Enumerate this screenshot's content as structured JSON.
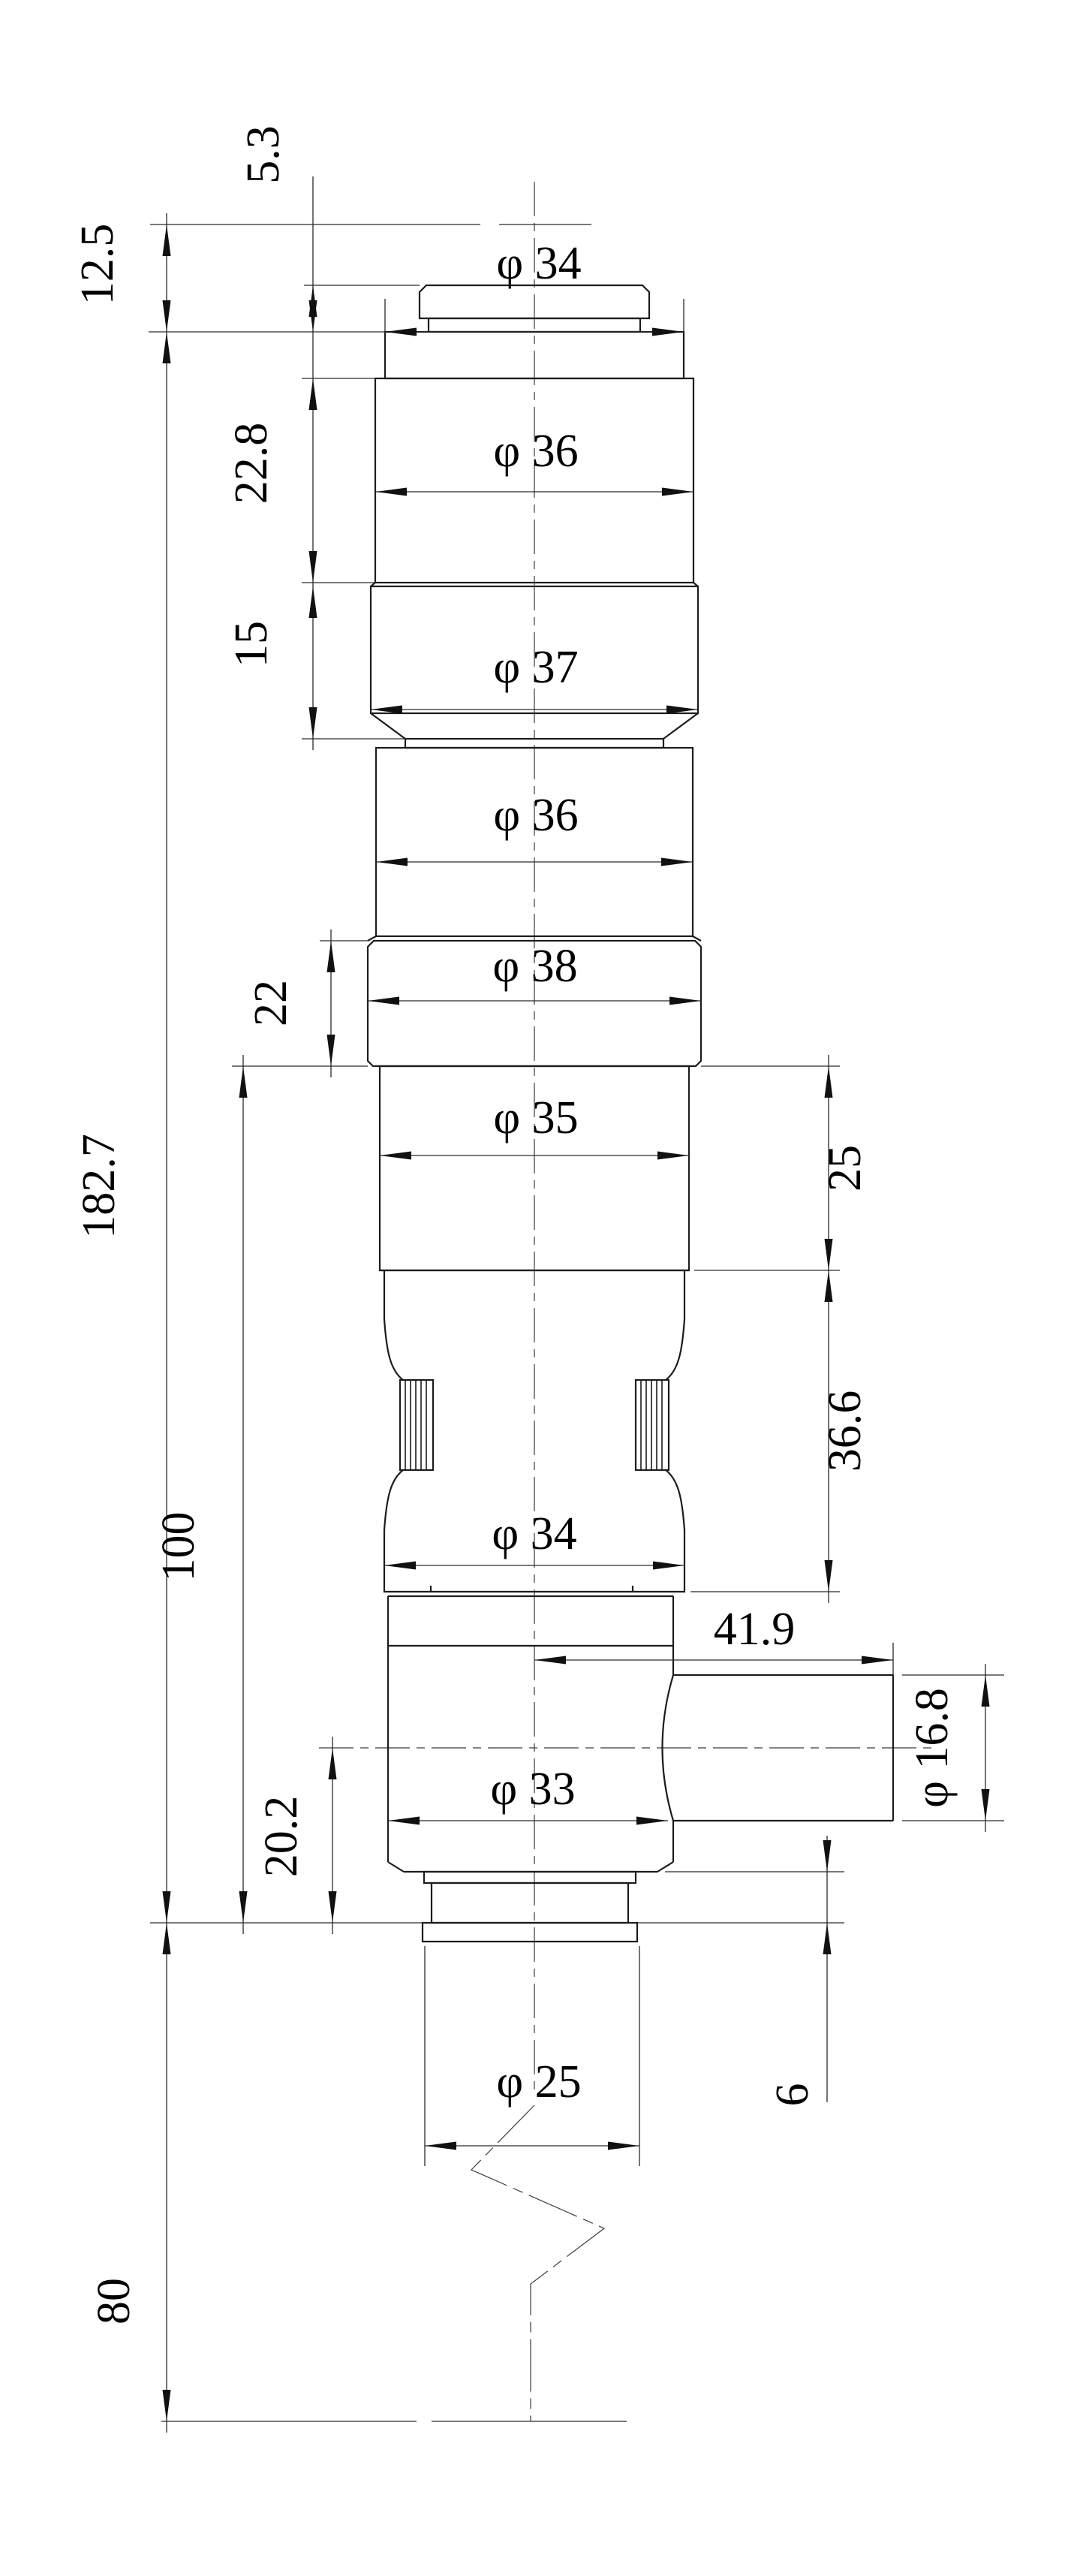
{
  "drawing": {
    "kind": "dimensioned technical drawing",
    "view": "front view of stepped cylindrical barrel with right-side port and cable break symbol",
    "background_color": "#ffffff",
    "line_color": "#1c1c1c",
    "diameter_symbol": "φ",
    "dimensions": {
      "cap_offset": "5.3",
      "cap_to_collar": "12.5",
      "upper_section_height": "22.8",
      "ring_section_height": "15",
      "mid_section_height": "22",
      "overall_height": "182.7",
      "lower_assembly_height": "100",
      "port_axis_to_base": "20.2",
      "base_to_cable_end": "80",
      "neck_section_height": "25",
      "waist_section_height": "36.6",
      "port_length": "41.9",
      "base_ring_height": "6",
      "dia_cap_collar": "φ 34",
      "dia_upper_body": "φ 36",
      "dia_upper_ring": "φ 37",
      "dia_mid_body": "φ 36",
      "dia_wide_ring": "φ 38",
      "dia_neck": "φ 35",
      "dia_waist": "φ 34",
      "dia_lower_body": "φ 33",
      "dia_port": "φ 16.8",
      "dia_base_flange": "φ 25"
    }
  }
}
